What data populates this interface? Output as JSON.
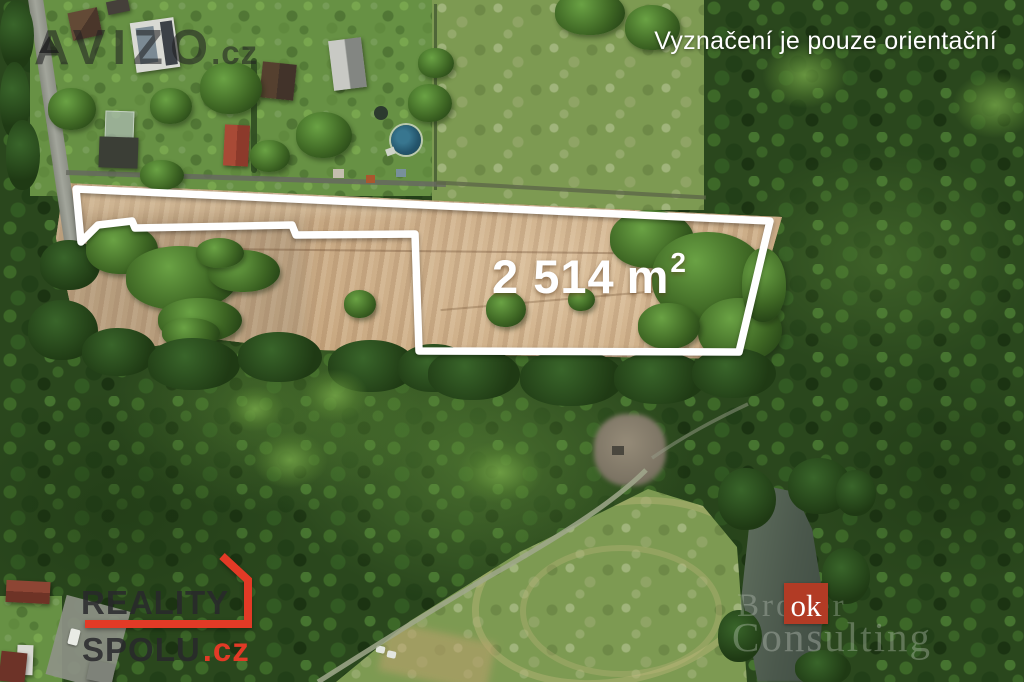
{
  "overlay": {
    "brand": {
      "name": "AVIZO",
      "tld": ".cz"
    },
    "disclaimer": "Vyznačení je pouze orientační",
    "plot": {
      "area_value": "2 514",
      "area_unit": "m",
      "area_exponent": "2",
      "outline_points": "76,189 770,221 739,352 419,351 415,234 296,235 292,225 135,228 132,221 98,225 81,242",
      "outline_color": "#ffffff"
    },
    "footer_brand": {
      "line1": "REALITY",
      "line2": "SPOLU",
      "tld": ".cz",
      "accent_color": "#e23a26",
      "frame_points": "85,624 248,624 248,580 222,556"
    },
    "watermark": {
      "square_text": "ok",
      "faint_line1": "Broker",
      "faint_line2": "Consulting",
      "square_color": "#b23b25"
    }
  }
}
